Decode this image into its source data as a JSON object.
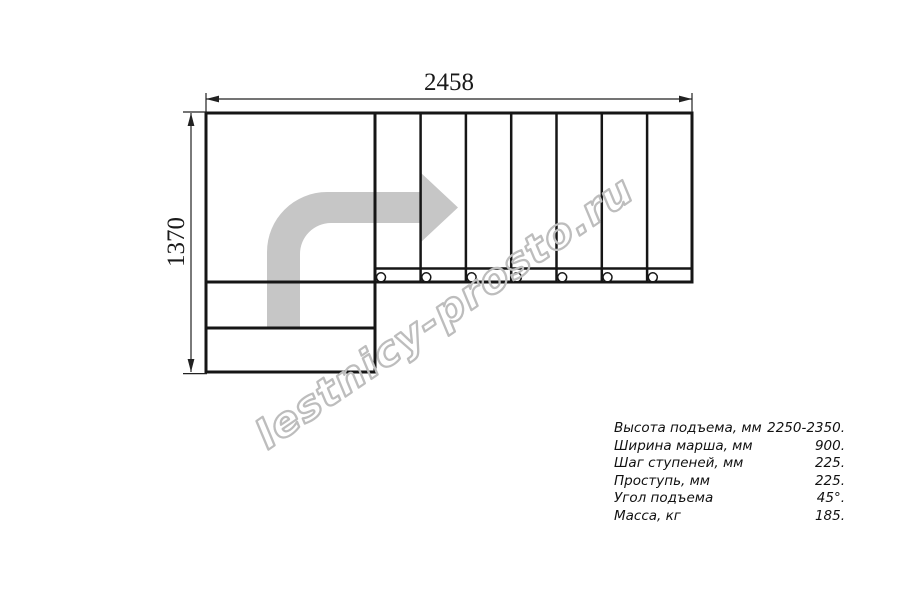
{
  "drawing": {
    "width_dimension": "2458",
    "height_dimension": "1370",
    "watermark": "lestnicy-prosto.ru",
    "flight_treads": 7,
    "lower_steps": 2,
    "has_landing": true,
    "turn_direction": "right"
  },
  "specs": {
    "rows": [
      {
        "label": "Высота подъема, мм",
        "value": "2250-2350."
      },
      {
        "label": "Ширина марша, мм",
        "value": "900."
      },
      {
        "label": "Шаг ступеней, мм",
        "value": "225."
      },
      {
        "label": "Проступь, мм",
        "value": "225."
      },
      {
        "label": "Угол подъема",
        "value": "45°."
      },
      {
        "label": "Масса, кг",
        "value": "185."
      }
    ]
  },
  "colors": {
    "background": "#ffffff",
    "outline": "#161616",
    "dimension": "#222222",
    "arrow_fill": "#c6c6c6",
    "watermark_stroke": "#bdbdbd",
    "spec_text": "#111111"
  }
}
